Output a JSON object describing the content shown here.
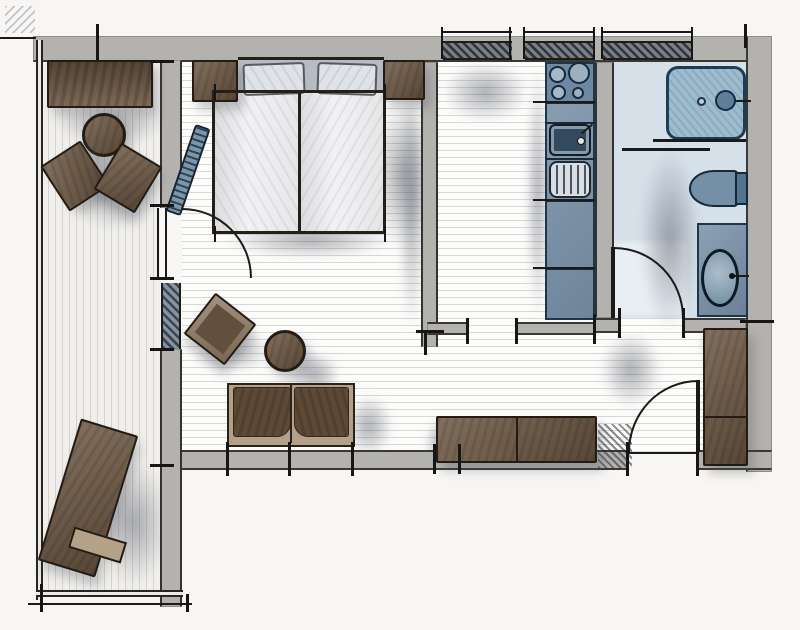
{
  "meta": {
    "description": "Hand-drawn top-view floor plan sketch of a one-room apartment with balcony, sleeping area, living area, kitchenette and bathroom",
    "drawing_type": "floor-plan-sketch"
  },
  "palette": {
    "paper": "#f7f6f4",
    "wall_gray": "#b4b2af",
    "ink_black": "#1b1a18",
    "furniture_brown": "#6d5843",
    "furniture_brown_dark": "#5c4936",
    "sofa_frame_tan": "#b2a089",
    "fixture_blue": "#7e96ab",
    "fixture_blue_dark": "#2e4257",
    "shower_blue": "#9fbccf",
    "bath_floor_blue": "#d6e0e9",
    "mattress_white": "#ececee",
    "pillow_gray": "#dfe2e6",
    "floor_line_gray": "#d9d8d5",
    "window_hatch": "#30353c"
  },
  "rooms": {
    "balcony": {
      "name": "balcony",
      "furniture": [
        "bench",
        "round-table",
        "chair-left",
        "chair-right",
        "sun-lounger"
      ]
    },
    "bedroom": {
      "name": "sleeping-area",
      "furniture": [
        "double-bed",
        "pillow-left",
        "pillow-right",
        "nightstand-left",
        "nightstand-right",
        "radiator"
      ]
    },
    "living": {
      "name": "living-area",
      "furniture": [
        "armchair",
        "round-stool",
        "sofa",
        "sideboard",
        "wardrobe"
      ]
    },
    "kitchen": {
      "name": "kitchenette",
      "furniture": [
        "counter",
        "stove-four-burners",
        "sink",
        "drainboard"
      ]
    },
    "bathroom": {
      "name": "bathroom",
      "furniture": [
        "shower",
        "toilet",
        "washbasin-vanity"
      ]
    }
  },
  "openings": {
    "windows": [
      "top-wall-window-1",
      "top-wall-window-2",
      "top-wall-window-3",
      "left-wall-window"
    ],
    "doors": [
      "balcony-door",
      "kitchen-doorway",
      "bathroom-door",
      "entrance-door"
    ]
  }
}
